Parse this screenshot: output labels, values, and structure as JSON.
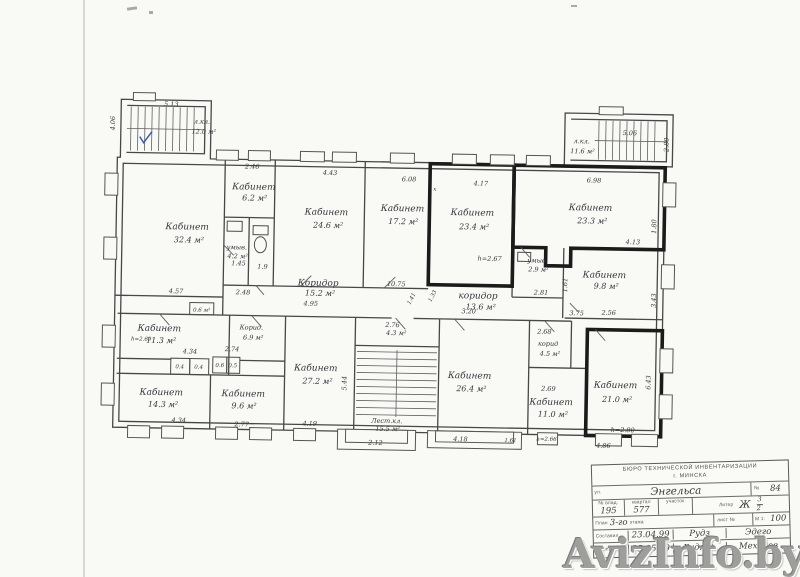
{
  "watermark": {
    "text": "AvizInfo.by"
  },
  "plan": {
    "rooms": {
      "stair_nw": {
        "name": "л.кл.",
        "area": "12.0 м²"
      },
      "stair_ne": {
        "name": "л.кл.",
        "area": "11.6 м²"
      },
      "stair_s": {
        "name": "Лест.кл.",
        "area": "15.5 м²"
      },
      "kab_32_4": {
        "name": "Кабинет",
        "area": "32.4 м²"
      },
      "kab_6_2": {
        "name": "Кабинет",
        "area": "6.2 м²"
      },
      "umyv_4_2": {
        "name": "умыв.",
        "area": "4.2 м²"
      },
      "wc_1_9": {
        "area": "1.9"
      },
      "kab_24_6": {
        "name": "Кабинет",
        "area": "24.6 м²"
      },
      "kab_17_2": {
        "name": "Кабинет",
        "area": "17.2 м²"
      },
      "kab_23_4": {
        "name": "Кабинет",
        "area": "23.4 м²"
      },
      "kab_23_3": {
        "name": "Кабинет",
        "area": "23.3 м²"
      },
      "kab_9_8": {
        "name": "Кабинет",
        "area": "9.8 м²"
      },
      "umyv_2_9": {
        "name": "умыв.",
        "area": "2.9 м²"
      },
      "kor_15_2": {
        "name": "Коридор",
        "area": "15.2 м²"
      },
      "kor_13_6": {
        "name": "коридор",
        "area": "13.6 м²"
      },
      "kab_11_3": {
        "name": "Кабинет",
        "area": "11.3 м²"
      },
      "kor_6_9": {
        "name": "Корид.",
        "area": "6.9 м²"
      },
      "closet_0_6": {
        "area": "0.6 м²"
      },
      "kab_14_3": {
        "name": "Кабинет",
        "area": "14.3 м²"
      },
      "kab_9_6": {
        "name": "Кабинет",
        "area": "9.6 м²"
      },
      "kab_27_2": {
        "name": "Кабинет",
        "area": "27.2 м²"
      },
      "room_4_3": {
        "area": "4.3 м²"
      },
      "kab_26_4": {
        "name": "Кабинет",
        "area": "26.4 м²"
      },
      "kor_4_5": {
        "name": "корид",
        "area": "4.5 м²"
      },
      "kab_11_0": {
        "name": "Кабинет",
        "area": "11.0 м²"
      },
      "kab_21_0": {
        "name": "Кабинет",
        "area": "21.0 м²"
      }
    },
    "dims": {
      "d513": "5.13",
      "d406": "4.06",
      "d246": "2.46",
      "d443": "4.43",
      "d608": "6.08",
      "d417": "4.17",
      "d698": "6.98",
      "d506": "5.06",
      "d280": "2.80",
      "d413": "4.13",
      "d180": "1.80",
      "d457": "4.57",
      "d248": "2.48",
      "d495": "4.95",
      "d1075": "10.75",
      "d141": "1.41",
      "d133": "1.33",
      "d145": "1.45",
      "d281": "2.81",
      "d375": "3.75",
      "d256": "2.56",
      "d161a": "1.61",
      "d343": "3.43",
      "d268": "2.68",
      "d274": "2.74",
      "d434a": "4.34",
      "dh269": "h=2.69",
      "c04a": "0.4",
      "c04b": "0.4",
      "c06": "0.6",
      "c05": "0.5",
      "d434b": "4.34",
      "d277": "2.77",
      "d419": "4.19",
      "d544": "5.44",
      "d276": "2.76",
      "d212": "2.12",
      "d320": "3.20",
      "d418": "4.18",
      "d269": "2.69",
      "d161b": "1.61",
      "dh266": "h=2.66",
      "d643": "6.43",
      "d486": "4.86",
      "dh280": "h=2.80",
      "dh267": "h=2.67",
      "x_mark": "х"
    }
  },
  "title_block": {
    "header_line1": "БЮРО ТЕХНИЧЕСКОЙ ИНВЕНТАРИЗАЦИИ",
    "header_line2": "г. МИНСКА",
    "street_label": "ул.",
    "street_value": "Энгельса",
    "number_label": "№",
    "number_value": "84",
    "vlad_label": "№ влад.",
    "vlad_value": "195",
    "kvartal_label": "квартал",
    "kvartal_value": "577",
    "uchastok_label": "участок",
    "uchastok_value": "",
    "liter_label": "Литер",
    "liter_value": "Ж",
    "liter_frac_top": "3",
    "liter_frac_bottom": "2",
    "plan_label": "План",
    "floor_value": "3-го",
    "floor_suffix": "этажа",
    "sheet_label": "лист №",
    "scale_label": "М 1:",
    "scale_value": "100",
    "sostavil_label": "Составил",
    "sostavil_date": "23.04.99",
    "sostavil_sig": "Рудз",
    "sostavil_sig2": "Эдего",
    "vychertil_label": "Вычертил",
    "vychertil_date": "25.05.99",
    "vychertil_sig": "Рудз О.",
    "vychertil_sig2": "Мехедов"
  }
}
